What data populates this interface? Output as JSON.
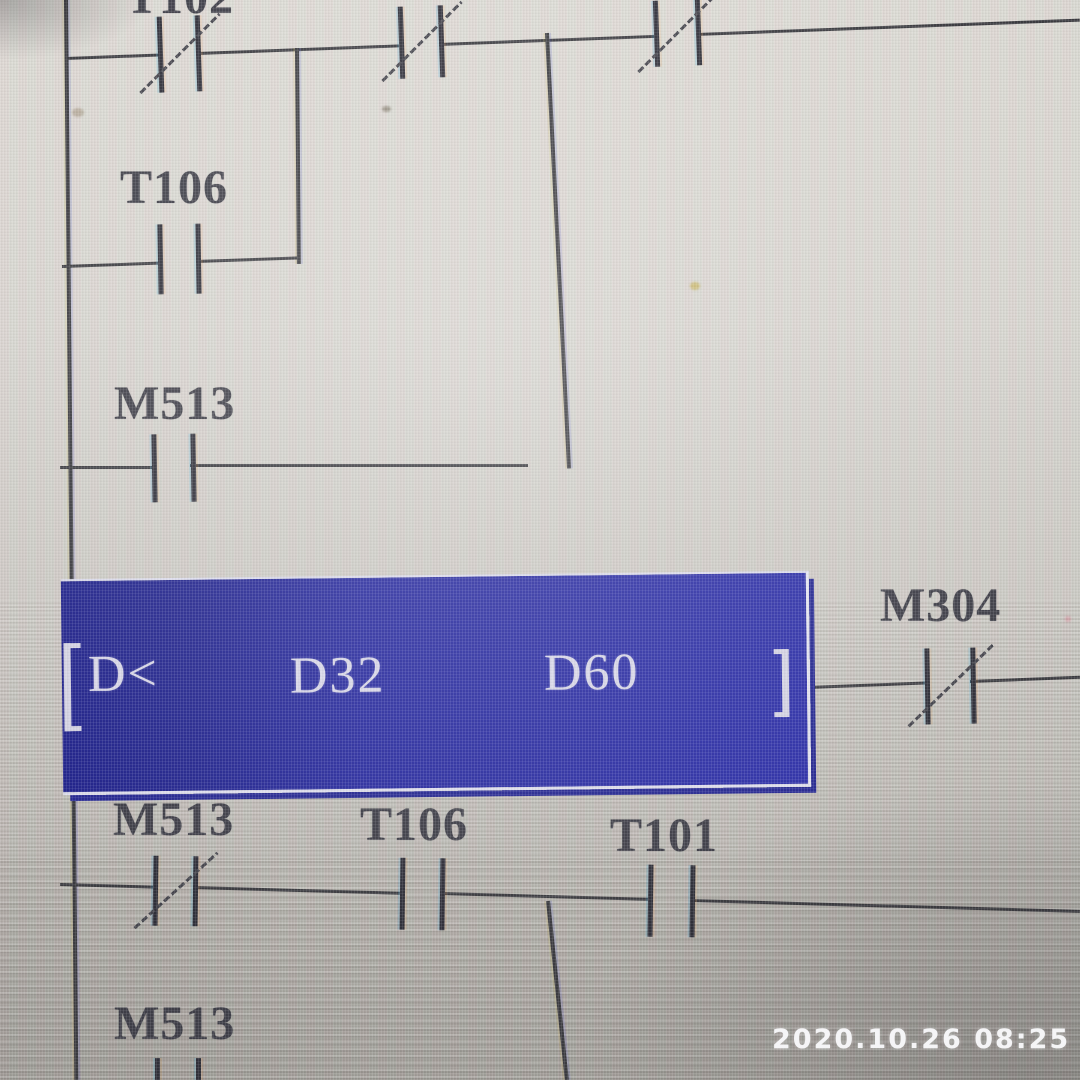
{
  "photo": {
    "timestamp_watermark": "2020.10.26 08:25"
  },
  "ladder": {
    "instruction": {
      "opcode": "D<",
      "operand1": "D32",
      "operand2": "D60",
      "display": "[D< D32 D60 ]",
      "state": "selected",
      "selection_color": "#2b2da0",
      "text_color": "#d6d5e6"
    },
    "contact_labels": {
      "rung1_contact1": "T102",
      "branch_t106": "T106",
      "branch_m513": "M513",
      "output_m304": "M304",
      "rung3_m513": "M513",
      "rung3_t106": "T106",
      "rung3_t101": "T101",
      "rung4_m513": "M513"
    },
    "rungs": [
      {
        "series": [
          {
            "label": "T102",
            "type": "NC"
          },
          {
            "label": "",
            "type": "NC"
          },
          {
            "label": "",
            "type": "NC"
          }
        ],
        "parallel": [
          {
            "label": "T106",
            "type": "NO"
          },
          {
            "label": "M513",
            "type": "NO"
          }
        ]
      },
      {
        "compare": "[D< D32 D60 ]",
        "series": [
          {
            "label": "M304",
            "type": "NC"
          }
        ]
      },
      {
        "series": [
          {
            "label": "M513",
            "type": "NC"
          },
          {
            "label": "T106",
            "type": "NO"
          },
          {
            "label": "T101",
            "type": "NO"
          }
        ]
      },
      {
        "series": [
          {
            "label": "M513",
            "type": "NO"
          }
        ],
        "clipped": true
      }
    ],
    "colors": {
      "wire": "#3c3c41",
      "label_text": "#3f3f48",
      "screen_bg": "#cfccc7"
    }
  }
}
